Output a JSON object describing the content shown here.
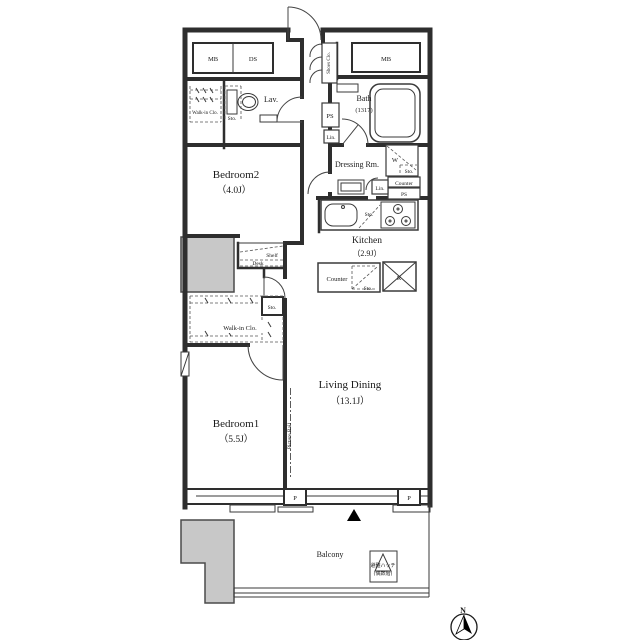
{
  "plan": {
    "rooms": {
      "bedroom2": {
        "name": "Bedroom2",
        "size": "（4.0J）"
      },
      "bedroom1": {
        "name": "Bedroom1",
        "size": "（5.5J）"
      },
      "living": {
        "name": "Living Dining",
        "size": "（13.1J）"
      },
      "kitchen": {
        "name": "Kitchen",
        "size": "（2.9J）"
      },
      "bath": {
        "name": "Bath",
        "size": "(1317)"
      },
      "dressing": {
        "name": "Dressing Rm."
      },
      "lav": {
        "name": "Lav."
      },
      "balcony": {
        "name": "Balcony"
      }
    },
    "storage": {
      "walk_in_closet": "Walk-in Clo.",
      "shoes_closet": "Shoes Clo.",
      "storage": "Sto.",
      "linen": "Lin.",
      "shelf": "Shelf",
      "desk": "Desk"
    },
    "utility": {
      "meter_box": "MB",
      "duct_space": "DS",
      "pipe_space": "PS",
      "washer": "W",
      "counter": "Counter",
      "refrigerator": "R",
      "pillar": "P",
      "picture_rail": "Picture Rail"
    },
    "annotations": {
      "hatch_line1": "避難ハッチ",
      "hatch_line2": "(偶数階)",
      "north": "N"
    },
    "colors": {
      "wall": "#2e2e2e",
      "structure_gray": "#c8c8c8",
      "background": "#ffffff"
    }
  }
}
